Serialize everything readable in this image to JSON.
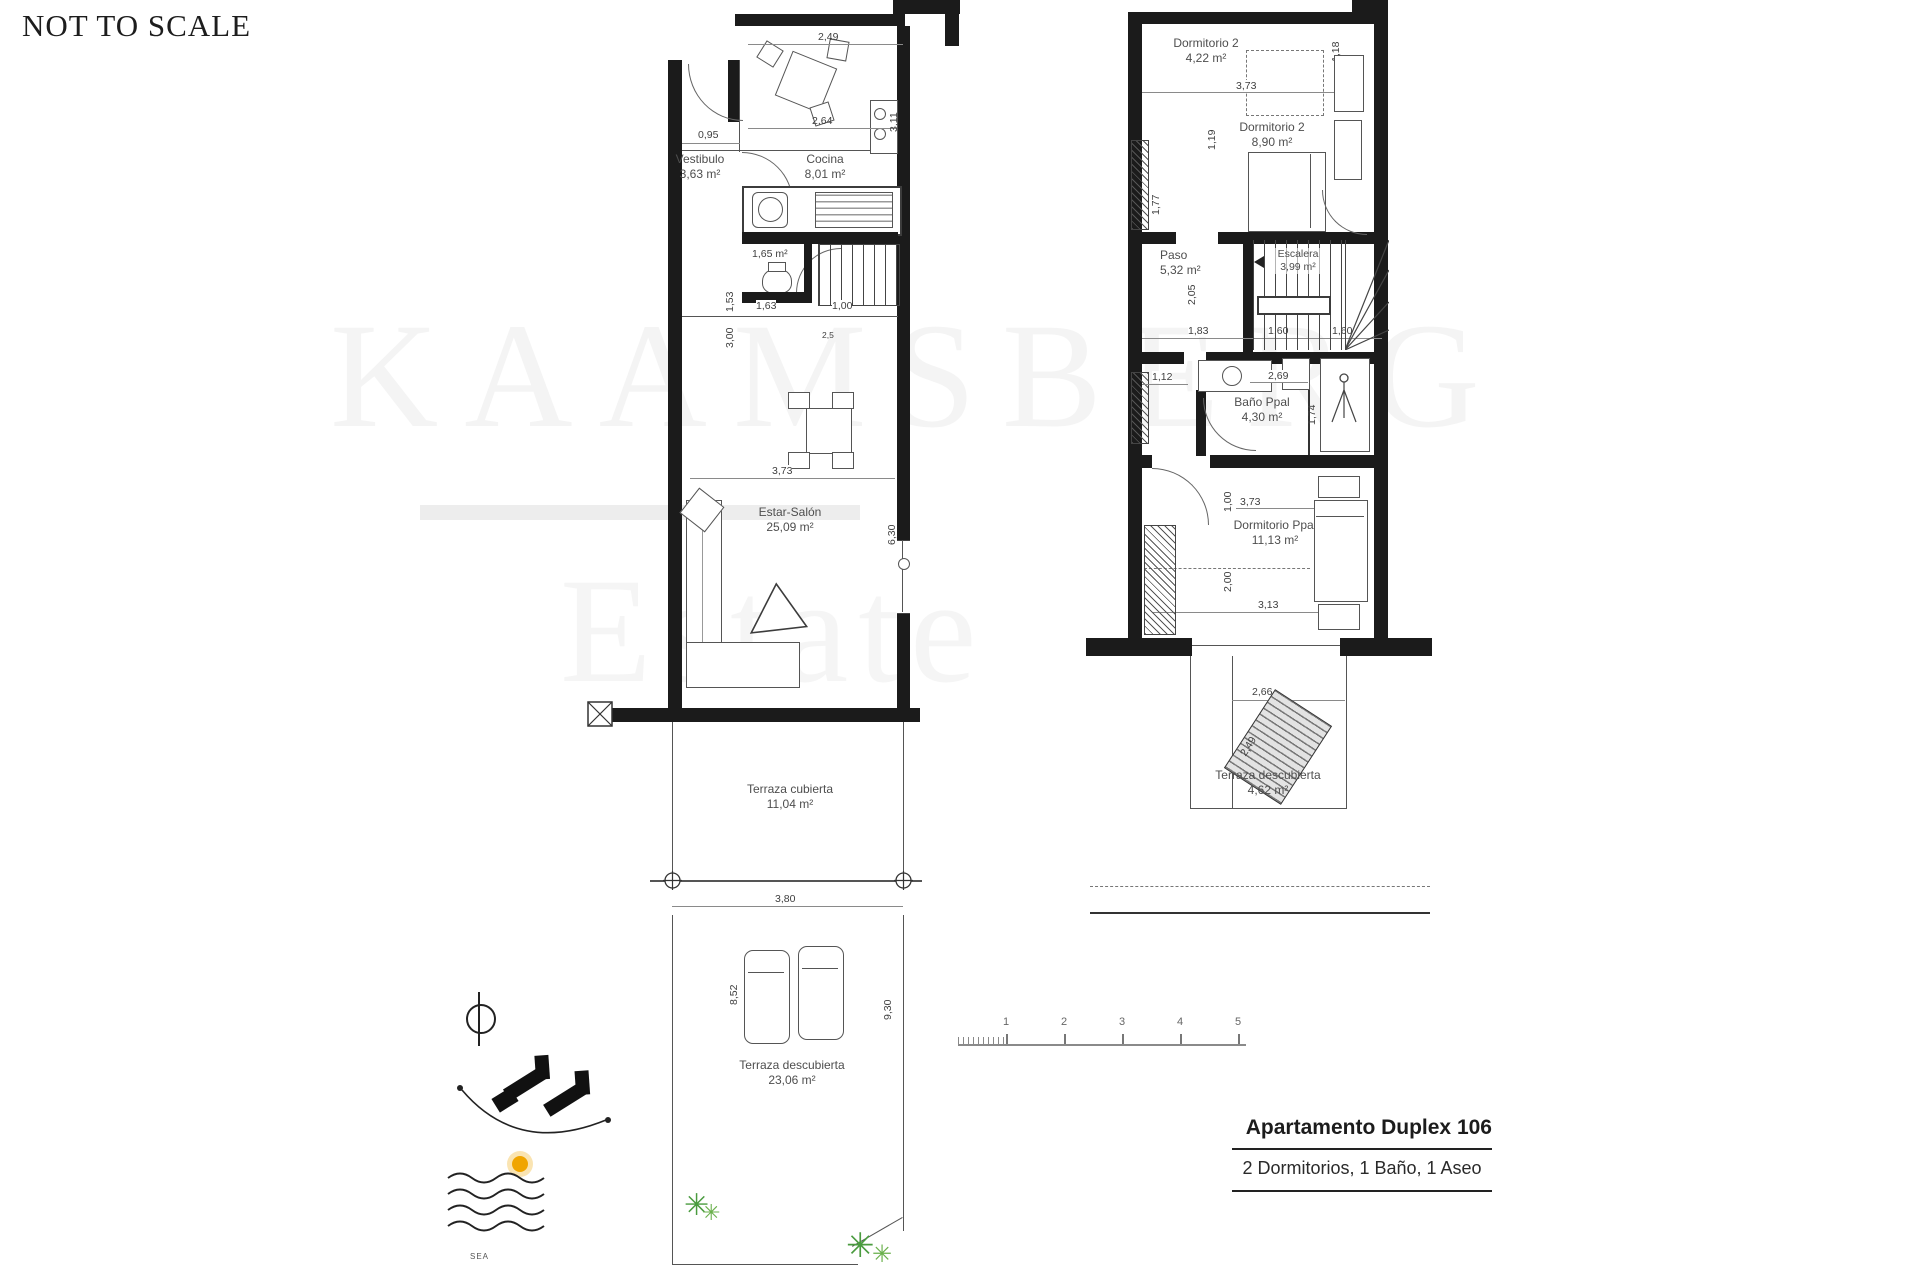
{
  "header": {
    "not_to_scale": "NOT TO SCALE"
  },
  "watermark": {
    "line1": "KAAMSBERG",
    "line2": "Estate"
  },
  "floor1": {
    "vestibulo": {
      "name": "Vestibulo",
      "area": "3,63 m²"
    },
    "cocina": {
      "name": "Cocina",
      "area": "8,01 m²"
    },
    "aseo": {
      "area": "1,65 m²"
    },
    "salon": {
      "name": "Estar-Salón",
      "area": "25,09 m²"
    },
    "terraza_cubierta": {
      "name": "Terraza cubierta",
      "area": "11,04 m²"
    },
    "terraza_descubierta": {
      "name": "Terraza descubierta",
      "area": "23,06 m²"
    },
    "dims": [
      "2,49",
      "2,64",
      "0,95",
      "3,11",
      "1,53",
      "3,00",
      "1,63",
      "1,00",
      "3,73",
      "6,30",
      "3,80",
      "8,52",
      "9,30",
      "2,5"
    ]
  },
  "floor2": {
    "dormitorio2a": {
      "name": "Dormitorio 2",
      "area": "4,22 m²"
    },
    "dormitorio2b": {
      "name": "Dormitorio 2",
      "area": "8,90 m²"
    },
    "paso": {
      "name": "Paso",
      "area": "5,32 m²"
    },
    "escalera": {
      "name": "Escalera",
      "area": "3,99 m²"
    },
    "bano": {
      "name": "Baño Ppal",
      "area": "4,30 m²"
    },
    "dormppal": {
      "name": "Dormitorio Ppal",
      "area": "11,13 m²"
    },
    "terraza": {
      "name": "Terraza descubierta",
      "area": "4,62 m²"
    },
    "dims": [
      "3,73",
      "1,18",
      "1,19",
      "1,77",
      "2,05",
      "1,83",
      "1,60",
      "1,60",
      "1,12",
      "2,69",
      "1,74",
      "1,00",
      "3,73",
      "2,00",
      "3,13",
      "2,66",
      "2,49"
    ]
  },
  "scalebar": {
    "labels": [
      "1",
      "2",
      "3",
      "4",
      "5"
    ]
  },
  "titleblock": {
    "title": "Apartamento Duplex 106",
    "subtitle": "2 Dormitorios, 1 Baño, 1 Aseo"
  },
  "site": {
    "sea_label": "SEA",
    "plant_glyph": "✳"
  },
  "colors": {
    "wall": "#1b1b1b",
    "accent_sun": "#f0a500",
    "plant": "#4a9b3f"
  }
}
